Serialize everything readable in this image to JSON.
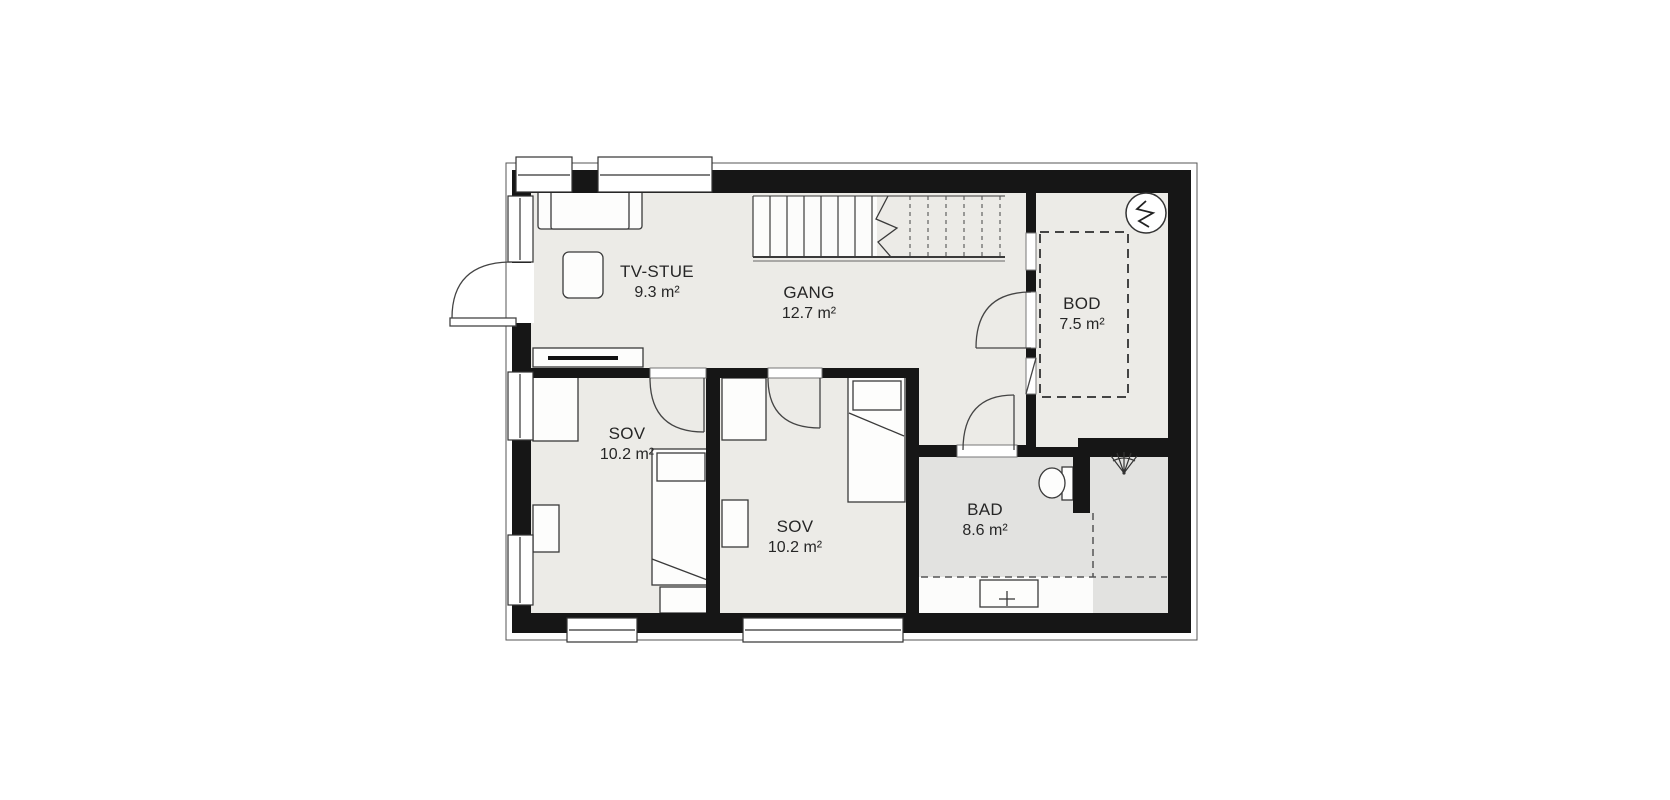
{
  "floorplan": {
    "rooms": [
      {
        "id": "tv-stue",
        "name": "TV-STUE",
        "area": "9.3 m²"
      },
      {
        "id": "gang",
        "name": "GANG",
        "area": "12.7 m²"
      },
      {
        "id": "bod",
        "name": "BOD",
        "area": "7.5 m²"
      },
      {
        "id": "sov-left",
        "name": "SOV",
        "area": "10.2 m²"
      },
      {
        "id": "sov-mid",
        "name": "SOV",
        "area": "10.2 m²"
      },
      {
        "id": "bad",
        "name": "BAD",
        "area": "8.6 m²"
      }
    ],
    "symbols": {
      "water_heater": "water-heater-circle-symbol",
      "shower": "shower-spray-symbol",
      "stairs": "staircase-with-break-line",
      "storage_zone": "dashed-storage-outline",
      "shower_zone": "dashed-shower-boundary"
    },
    "colors": {
      "wall": "#161616",
      "floor": "#ecebe7",
      "bathroom_floor": "#e2e2e0",
      "stair_floor": "#fcfcfb",
      "fixture_fill": "#fdfdfc",
      "line": "#3a3a3a",
      "background": "#ffffff"
    }
  }
}
